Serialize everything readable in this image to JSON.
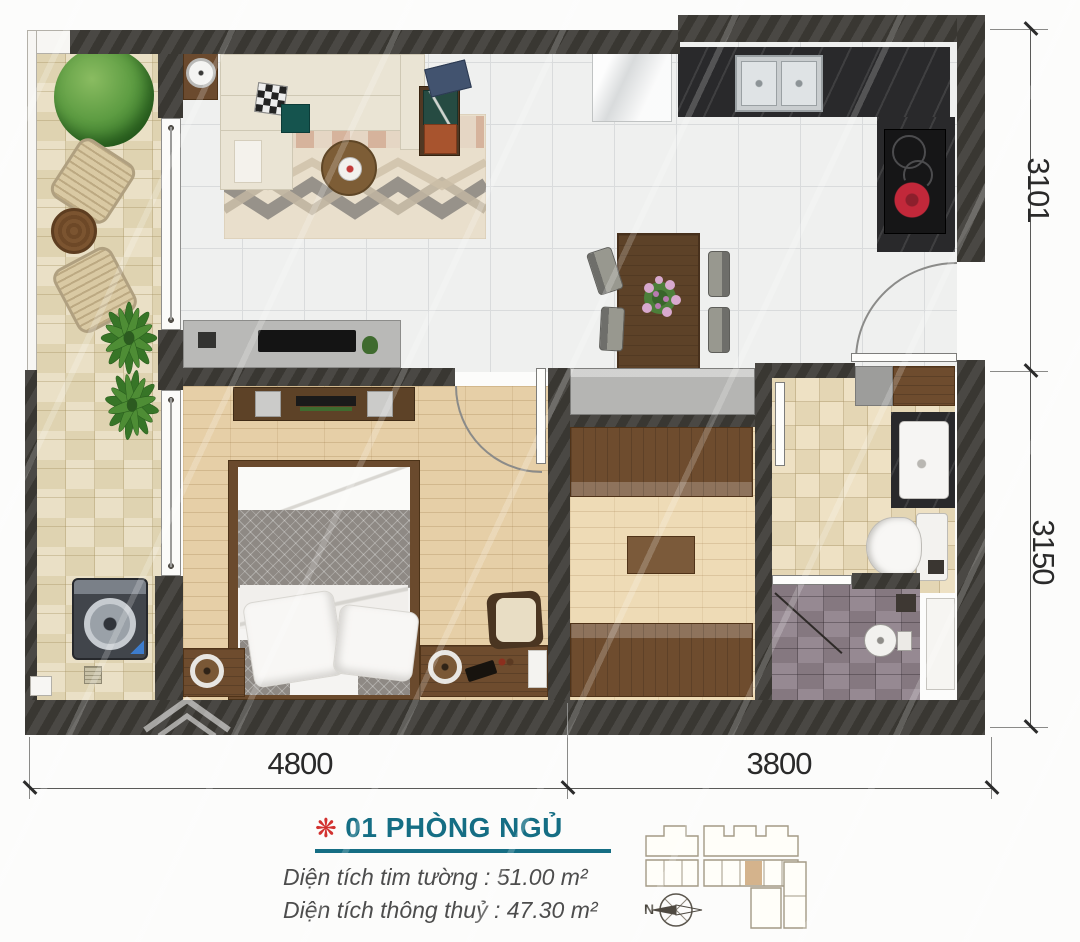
{
  "dimensions": {
    "right_top": "3101",
    "right_bottom": "3150",
    "bottom_left": "4800",
    "bottom_right": "3800"
  },
  "footer": {
    "flower_icon": "❋",
    "unit_title": "01 PHÒNG NGỦ",
    "area_line_1": "Diện tích tim tường : 51.00 m²",
    "area_line_2": "Diện tích thông thuỷ : 47.30 m²"
  },
  "key_plan": {
    "north_label": "N"
  },
  "colors": {
    "title_teal": "#156e84",
    "flower_red": "#d23230",
    "wall_dark": "#3f3d38",
    "highlighted_unit_tan": "#d4b38c",
    "dimension_text": "#2a2a2a"
  }
}
